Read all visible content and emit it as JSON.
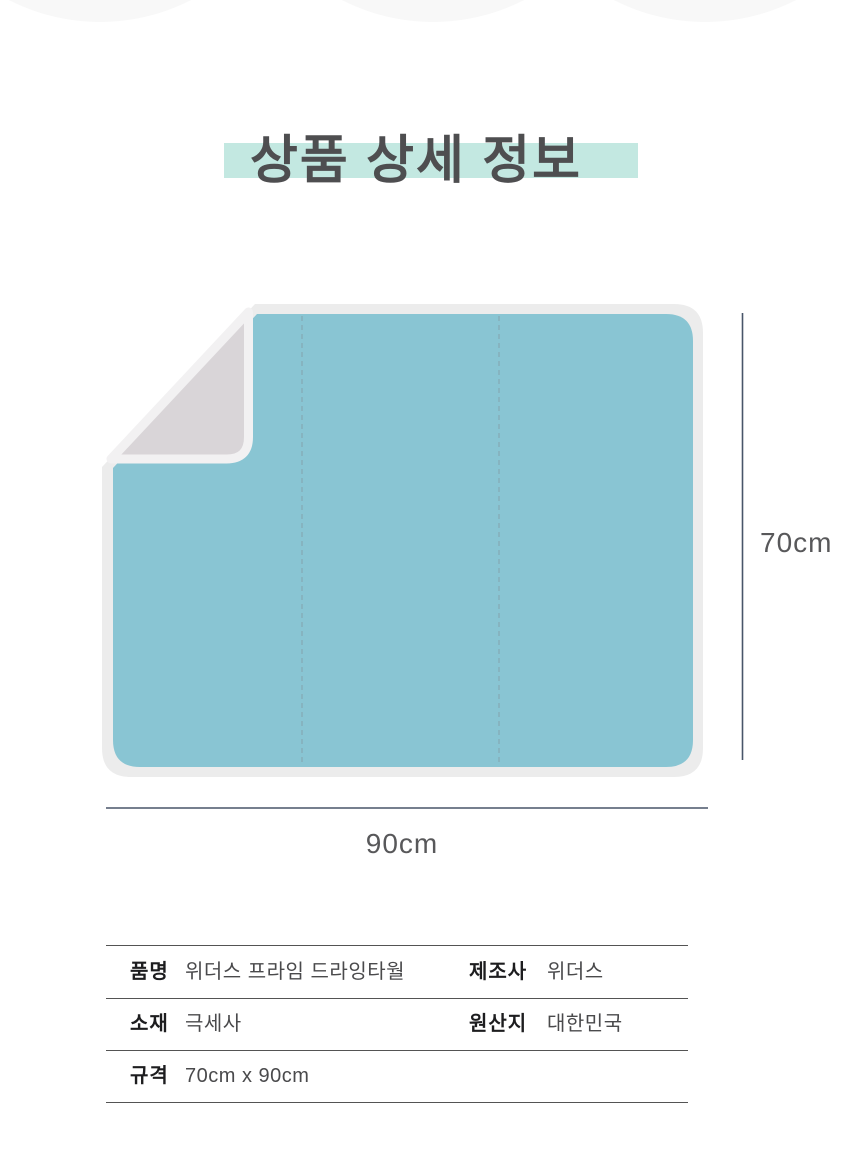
{
  "title": {
    "text": "상품 상세 정보",
    "highlight_color": "#c3e8e1",
    "text_color": "#4e4e50"
  },
  "figure": {
    "towel_color": "#89c5d3",
    "border_color": "#ececec",
    "fold_color": "#d9d5d8",
    "fold_edge_color": "#f2f1f2",
    "fold_line_color": "#85adb8",
    "dimension_line_color": "#485569",
    "height_label": "70cm",
    "width_label": "90cm"
  },
  "spec_table": {
    "rows": [
      {
        "cells": [
          {
            "label": "품명",
            "value": "위더스 프라임 드라잉타월"
          },
          {
            "label": "제조사",
            "value": "위더스"
          }
        ]
      },
      {
        "cells": [
          {
            "label": "소재",
            "value": "극세사"
          },
          {
            "label": "원산지",
            "value": "대한민국"
          }
        ]
      },
      {
        "cells": [
          {
            "label": "규격",
            "value": "70cm x 90cm"
          }
        ]
      }
    ]
  }
}
